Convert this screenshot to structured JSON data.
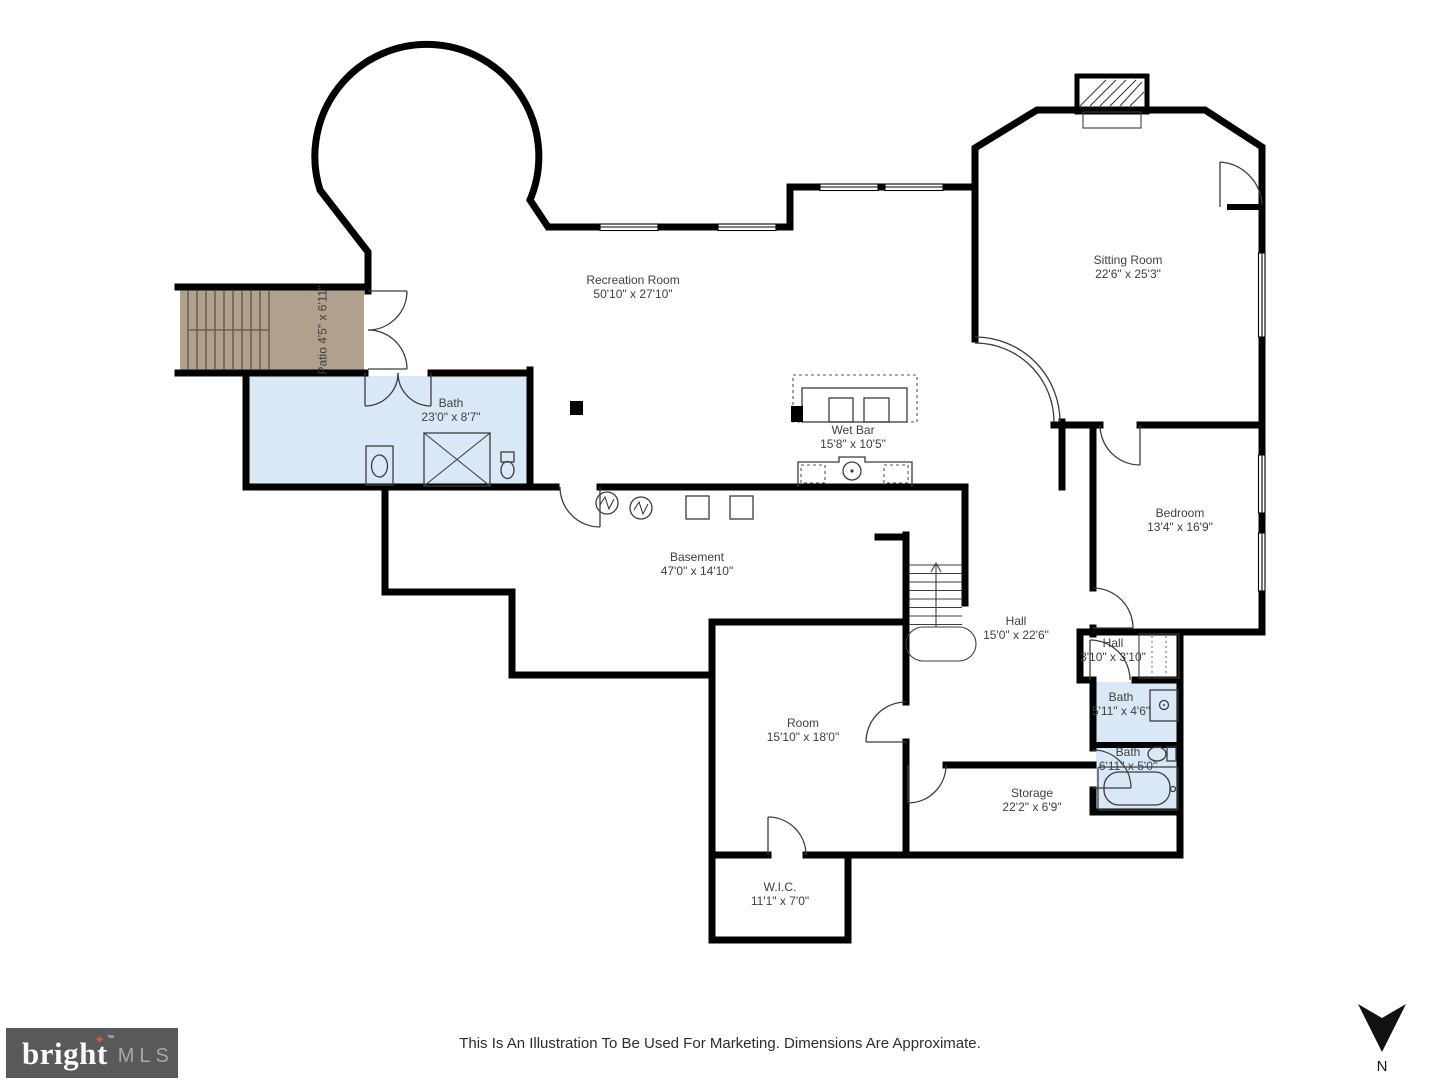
{
  "page": {
    "background": "#ffffff"
  },
  "floorplan": {
    "rooms": [
      {
        "id": "recreation-room",
        "name": "Recreation Room",
        "dims": "50'10\" x 27'10\""
      },
      {
        "id": "patio",
        "name": "Patio",
        "dims": "4'5\" x 6'11\""
      },
      {
        "id": "bath-main",
        "name": "Bath",
        "dims": "23'0\" x 8'7\""
      },
      {
        "id": "wet-bar",
        "name": "Wet Bar",
        "dims": "15'8\" x 10'5\""
      },
      {
        "id": "sitting-room",
        "name": "Sitting Room",
        "dims": "22'6\" x 25'3\""
      },
      {
        "id": "bedroom",
        "name": "Bedroom",
        "dims": "13'4\" x 16'9\""
      },
      {
        "id": "basement",
        "name": "Basement",
        "dims": "47'0\" x 14'10\""
      },
      {
        "id": "hall",
        "name": "Hall",
        "dims": "15'0\" x 22'6\""
      },
      {
        "id": "hall-small",
        "name": "Hall",
        "dims": "3'10\" x 3'10\""
      },
      {
        "id": "bath-small-1",
        "name": "Bath",
        "dims": "5'11\" x 4'6\""
      },
      {
        "id": "bath-small-2",
        "name": "Bath",
        "dims": "6'11\" x 5'0\""
      },
      {
        "id": "room",
        "name": "Room",
        "dims": "15'10\" x 18'0\""
      },
      {
        "id": "storage",
        "name": "Storage",
        "dims": "22'2\" x 6'9\""
      },
      {
        "id": "wic",
        "name": "W.I.C.",
        "dims": "11'1\" x 7'0\""
      }
    ],
    "compass": {
      "label": "N"
    }
  },
  "footer": {
    "disclaimer": "This Is An Illustration To Be Used For Marketing. Dimensions Are Approximate.",
    "logo": {
      "wordmark": "bright",
      "star": "✦",
      "tm": "™",
      "suffix": "MLS"
    }
  },
  "colors": {
    "wall": "#000000",
    "bath_fill": "#d9e8f6",
    "patio_fill": "#b2a08f",
    "logo_bg": "#58595a",
    "logo_star": "#e8512e"
  }
}
